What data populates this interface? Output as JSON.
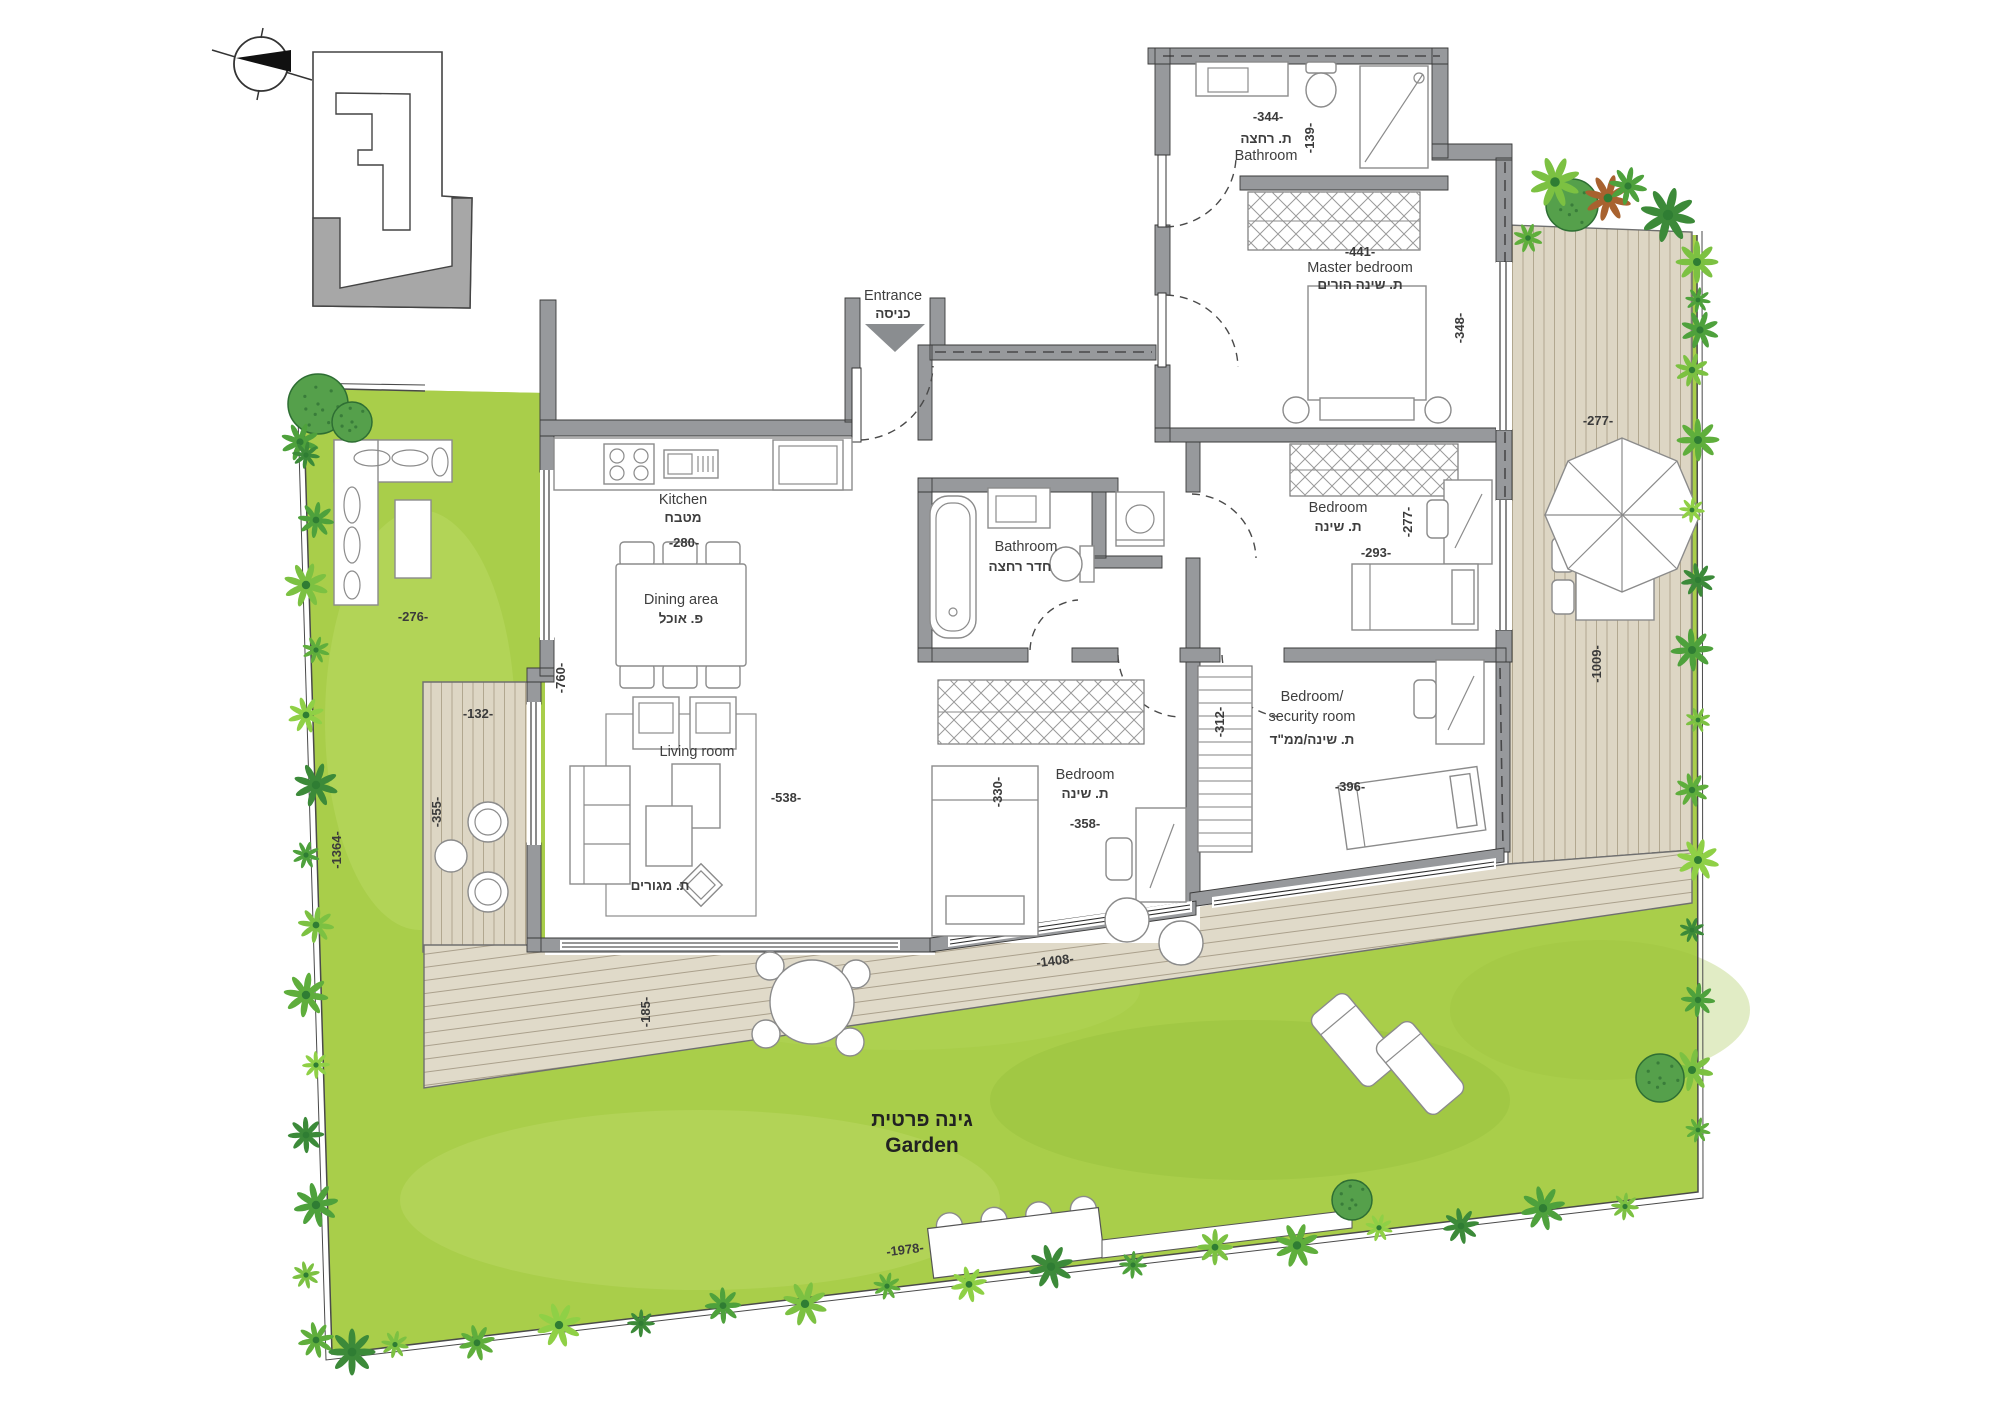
{
  "labels": {
    "bath_top": {
      "dim_w": "-344-",
      "he": "ת. רחצה",
      "en": "Bathroom",
      "dim_h": "-139-"
    },
    "master": {
      "dim_w": "-441-",
      "en": "Master bedroom",
      "he": "ת. שינה הורים",
      "dim_h": "-348-"
    },
    "bed_right": {
      "en": "Bedroom",
      "he": "ת. שינה",
      "dim_h": "-277-",
      "dim_w": "-293-"
    },
    "security": {
      "en1": "Bedroom/",
      "en2": "security room",
      "he": "ת. שינה/ממ\"ד",
      "dim_h": "-312-",
      "dim_w": "-396-"
    },
    "bed_mid": {
      "en": "Bedroom",
      "he": "ת. שינה",
      "dim_w": "-358-",
      "dim_h": "-330-"
    },
    "bath_mid": {
      "en": "Bathroom",
      "he": "חדר רחצה"
    },
    "kitchen": {
      "en": "Kitchen",
      "he": "מטבח",
      "dim": "-280-"
    },
    "dining": {
      "en": "Dining area",
      "he": "פ. אוכל"
    },
    "living": {
      "en": "Living room",
      "he": "ת. מגורים",
      "dim_w": "-538-",
      "dim_h": "-760-"
    },
    "entrance": {
      "en": "Entrance",
      "he": "כניסה"
    },
    "garden": {
      "he": "גינה פרטית",
      "en": "Garden",
      "dim_left": "-1364-",
      "dim_width": "-276-",
      "dim_bottom": "-1978-"
    },
    "deck_left": {
      "dim_w": "-132-",
      "dim_h": "-355-"
    },
    "deck_right": {
      "dim_w": "-277-",
      "dim_h": "-1009-"
    },
    "deck_bottom": {
      "dim_w": "-1408-",
      "dim_h": "-185-"
    }
  },
  "colors": {
    "grass": "#a9ce4a",
    "deck": "#ddd6c4",
    "deck_line": "#b1a78f",
    "wall": "#97999c",
    "plant_dark": "#3c8a39",
    "plant_mid": "#4ea13c",
    "plant_light": "#7cc142",
    "keyplan_gray": "#a7a7a7"
  }
}
